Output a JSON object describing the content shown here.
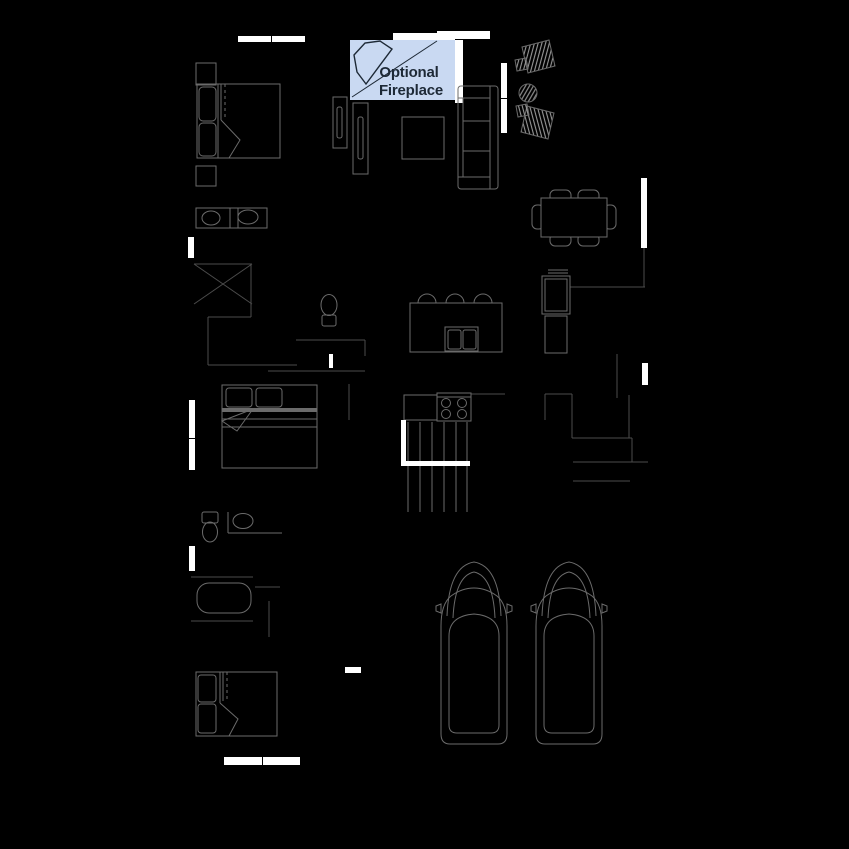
{
  "canvas": {
    "width": 849,
    "height": 849,
    "background": "#000000"
  },
  "annotation": {
    "line1": "Optional",
    "line2": "Fireplace"
  },
  "colors": {
    "background": "#000000",
    "window": "#ffffff",
    "wall": "#4c4c4c",
    "furniture": "#6b6b6b",
    "hatch": "#9a9a9a",
    "label_bg": "#c9d9f2",
    "label_text": "#1d2936"
  },
  "fixtures": [
    "optional-fireplace-label",
    "fireplace-icon",
    "master-bed",
    "nightstand",
    "double-vanity",
    "shower",
    "toilet",
    "media-console",
    "tv",
    "ottoman",
    "sofa",
    "accent-chair",
    "round-side-table",
    "dining-table",
    "dining-chair",
    "kitchen-island",
    "bar-stool",
    "kitchen-sink",
    "range-cooktop",
    "kitchen-counter",
    "refrigerator",
    "pantry-cabinet",
    "staircase",
    "stair-railing",
    "bed",
    "bathtub",
    "single-vanity",
    "car",
    "window"
  ]
}
